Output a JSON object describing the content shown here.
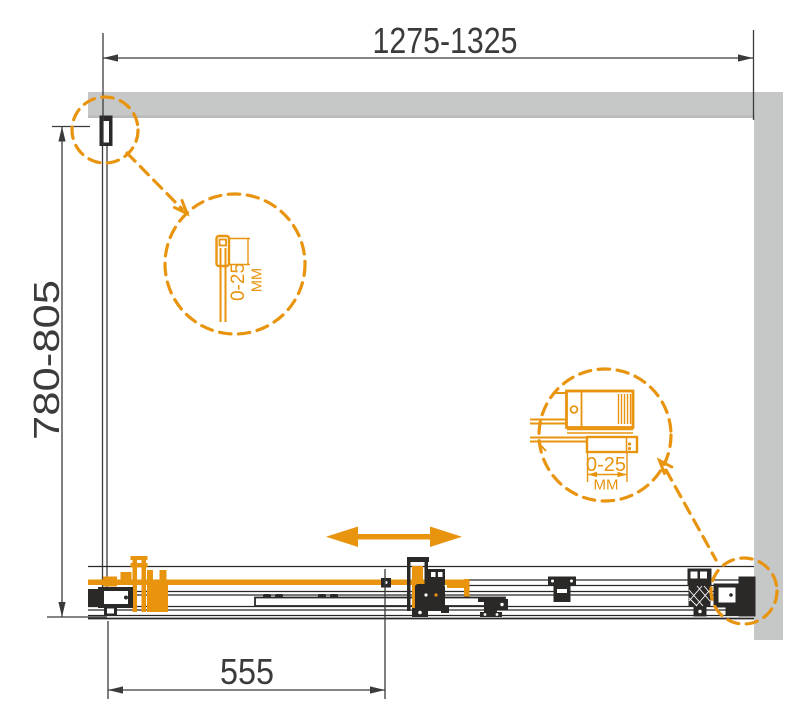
{
  "drawing": {
    "type": "shower-enclosure-plan-technical-drawing",
    "colors": {
      "accent_orange": "#E8940F",
      "wall_gray": "#C6C7C7",
      "line_black": "#2B2928",
      "dim_gray": "#3B3B3B"
    },
    "dimensions": {
      "overall_width": "1275-1325",
      "overall_depth": "780-805",
      "door_width": "555"
    },
    "detail_callouts": {
      "top_left_profile": {
        "adjustment": "0-25",
        "unit": "MM"
      },
      "bottom_right_profile": {
        "adjustment": "0-25",
        "unit": "MM"
      }
    }
  }
}
